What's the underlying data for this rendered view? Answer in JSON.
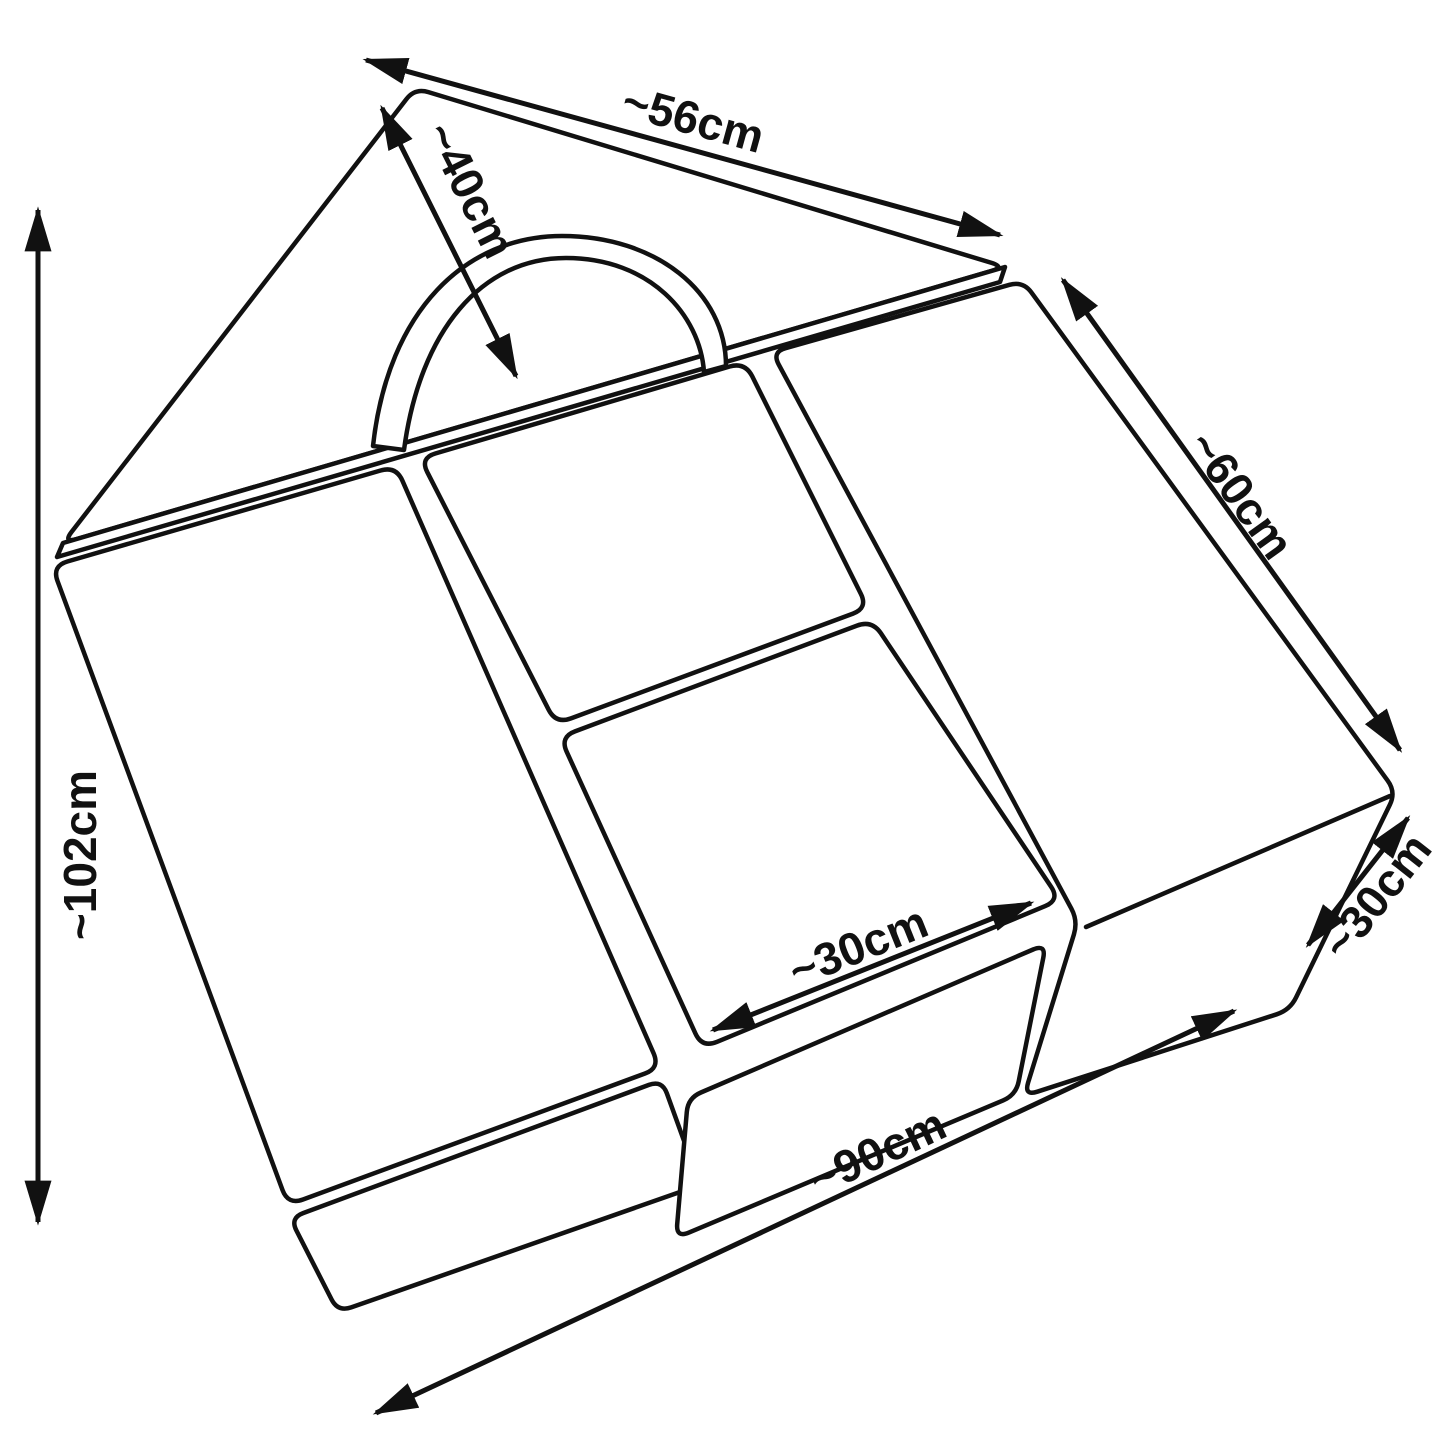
{
  "figure": {
    "kind": "technical dimension line drawing",
    "subject": "foam soft-play block set (wedge ramp with carry handle, two cubes, long block and front blocks) in perspective view",
    "background_color": "#ffffff",
    "line_color": "#111111"
  },
  "dims": [
    {
      "name": "overall-depth",
      "label": "~102cm"
    },
    {
      "name": "wedge-top-edge",
      "label": "~56cm"
    },
    {
      "name": "wedge-slope",
      "label": "~40cm"
    },
    {
      "name": "right-block-length",
      "label": "~60cm"
    },
    {
      "name": "right-block-depth",
      "label": "~30cm"
    },
    {
      "name": "middle-cube-width",
      "label": "~30cm"
    },
    {
      "name": "front-width",
      "label": "~90cm"
    }
  ]
}
